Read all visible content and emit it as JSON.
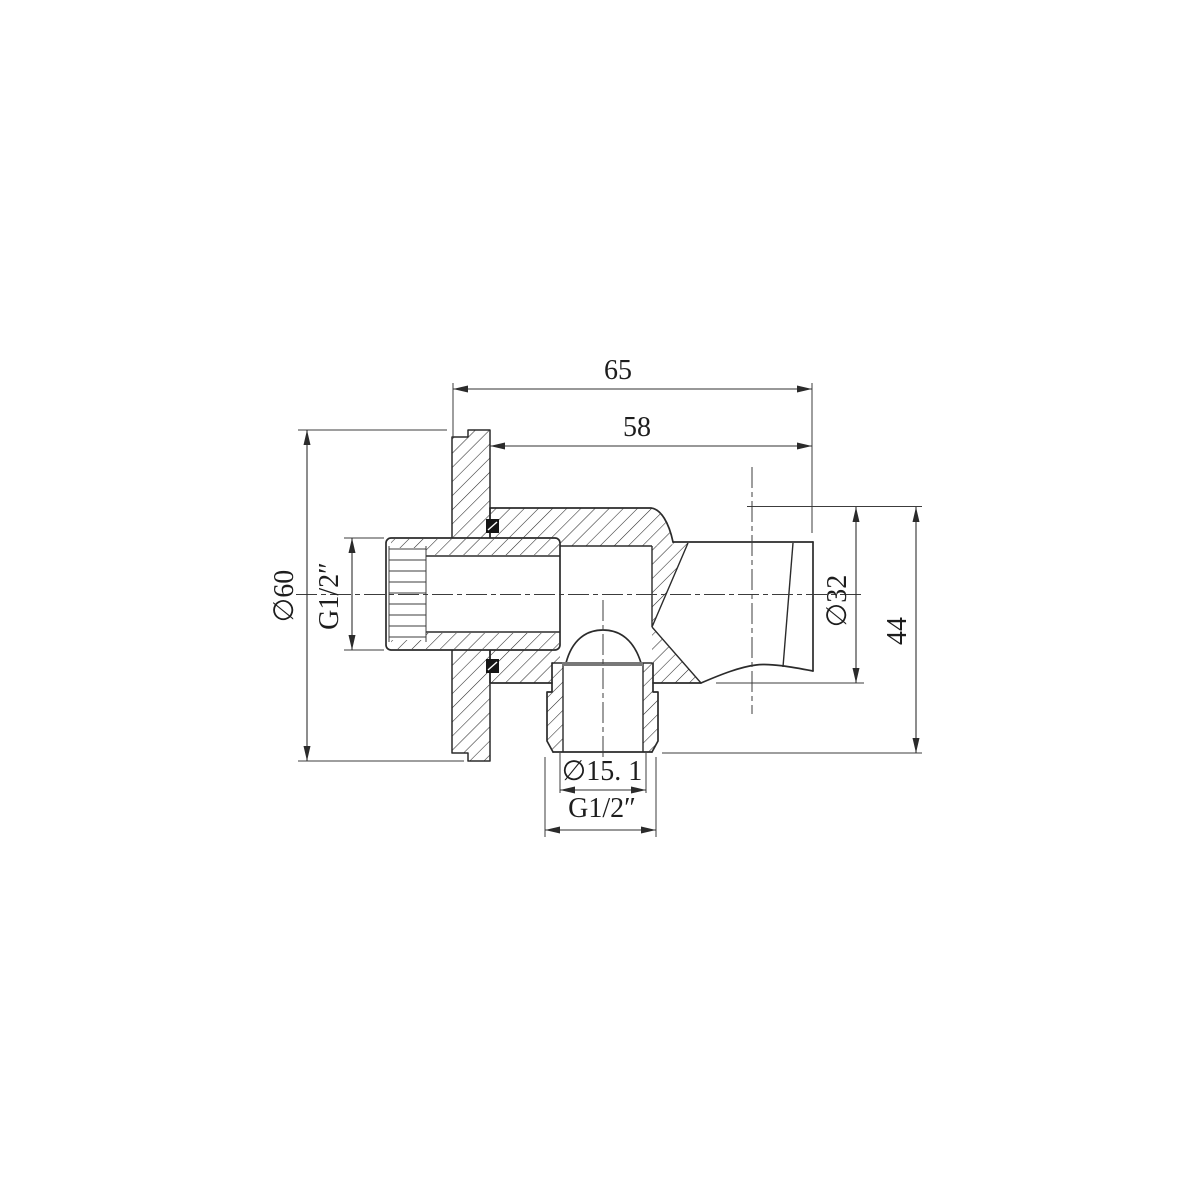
{
  "drawing": {
    "kind": "technical-section-drawing",
    "part_name": "shower-wall-outlet-elbow-with-handset-holder",
    "colors": {
      "background": "#ffffff",
      "line": "#2b2b2b",
      "seal_black": "#151515",
      "seat_gray": "#787878"
    },
    "dimensions": {
      "overall_depth": "65",
      "holder_to_wall": "58",
      "flange_diameter": "∅60",
      "inlet_thread": "G1/2″",
      "holder_diameter": "∅32",
      "overall_height": "44",
      "outlet_bore_diameter": "∅15. 1",
      "outlet_thread": "G1/2″"
    }
  }
}
